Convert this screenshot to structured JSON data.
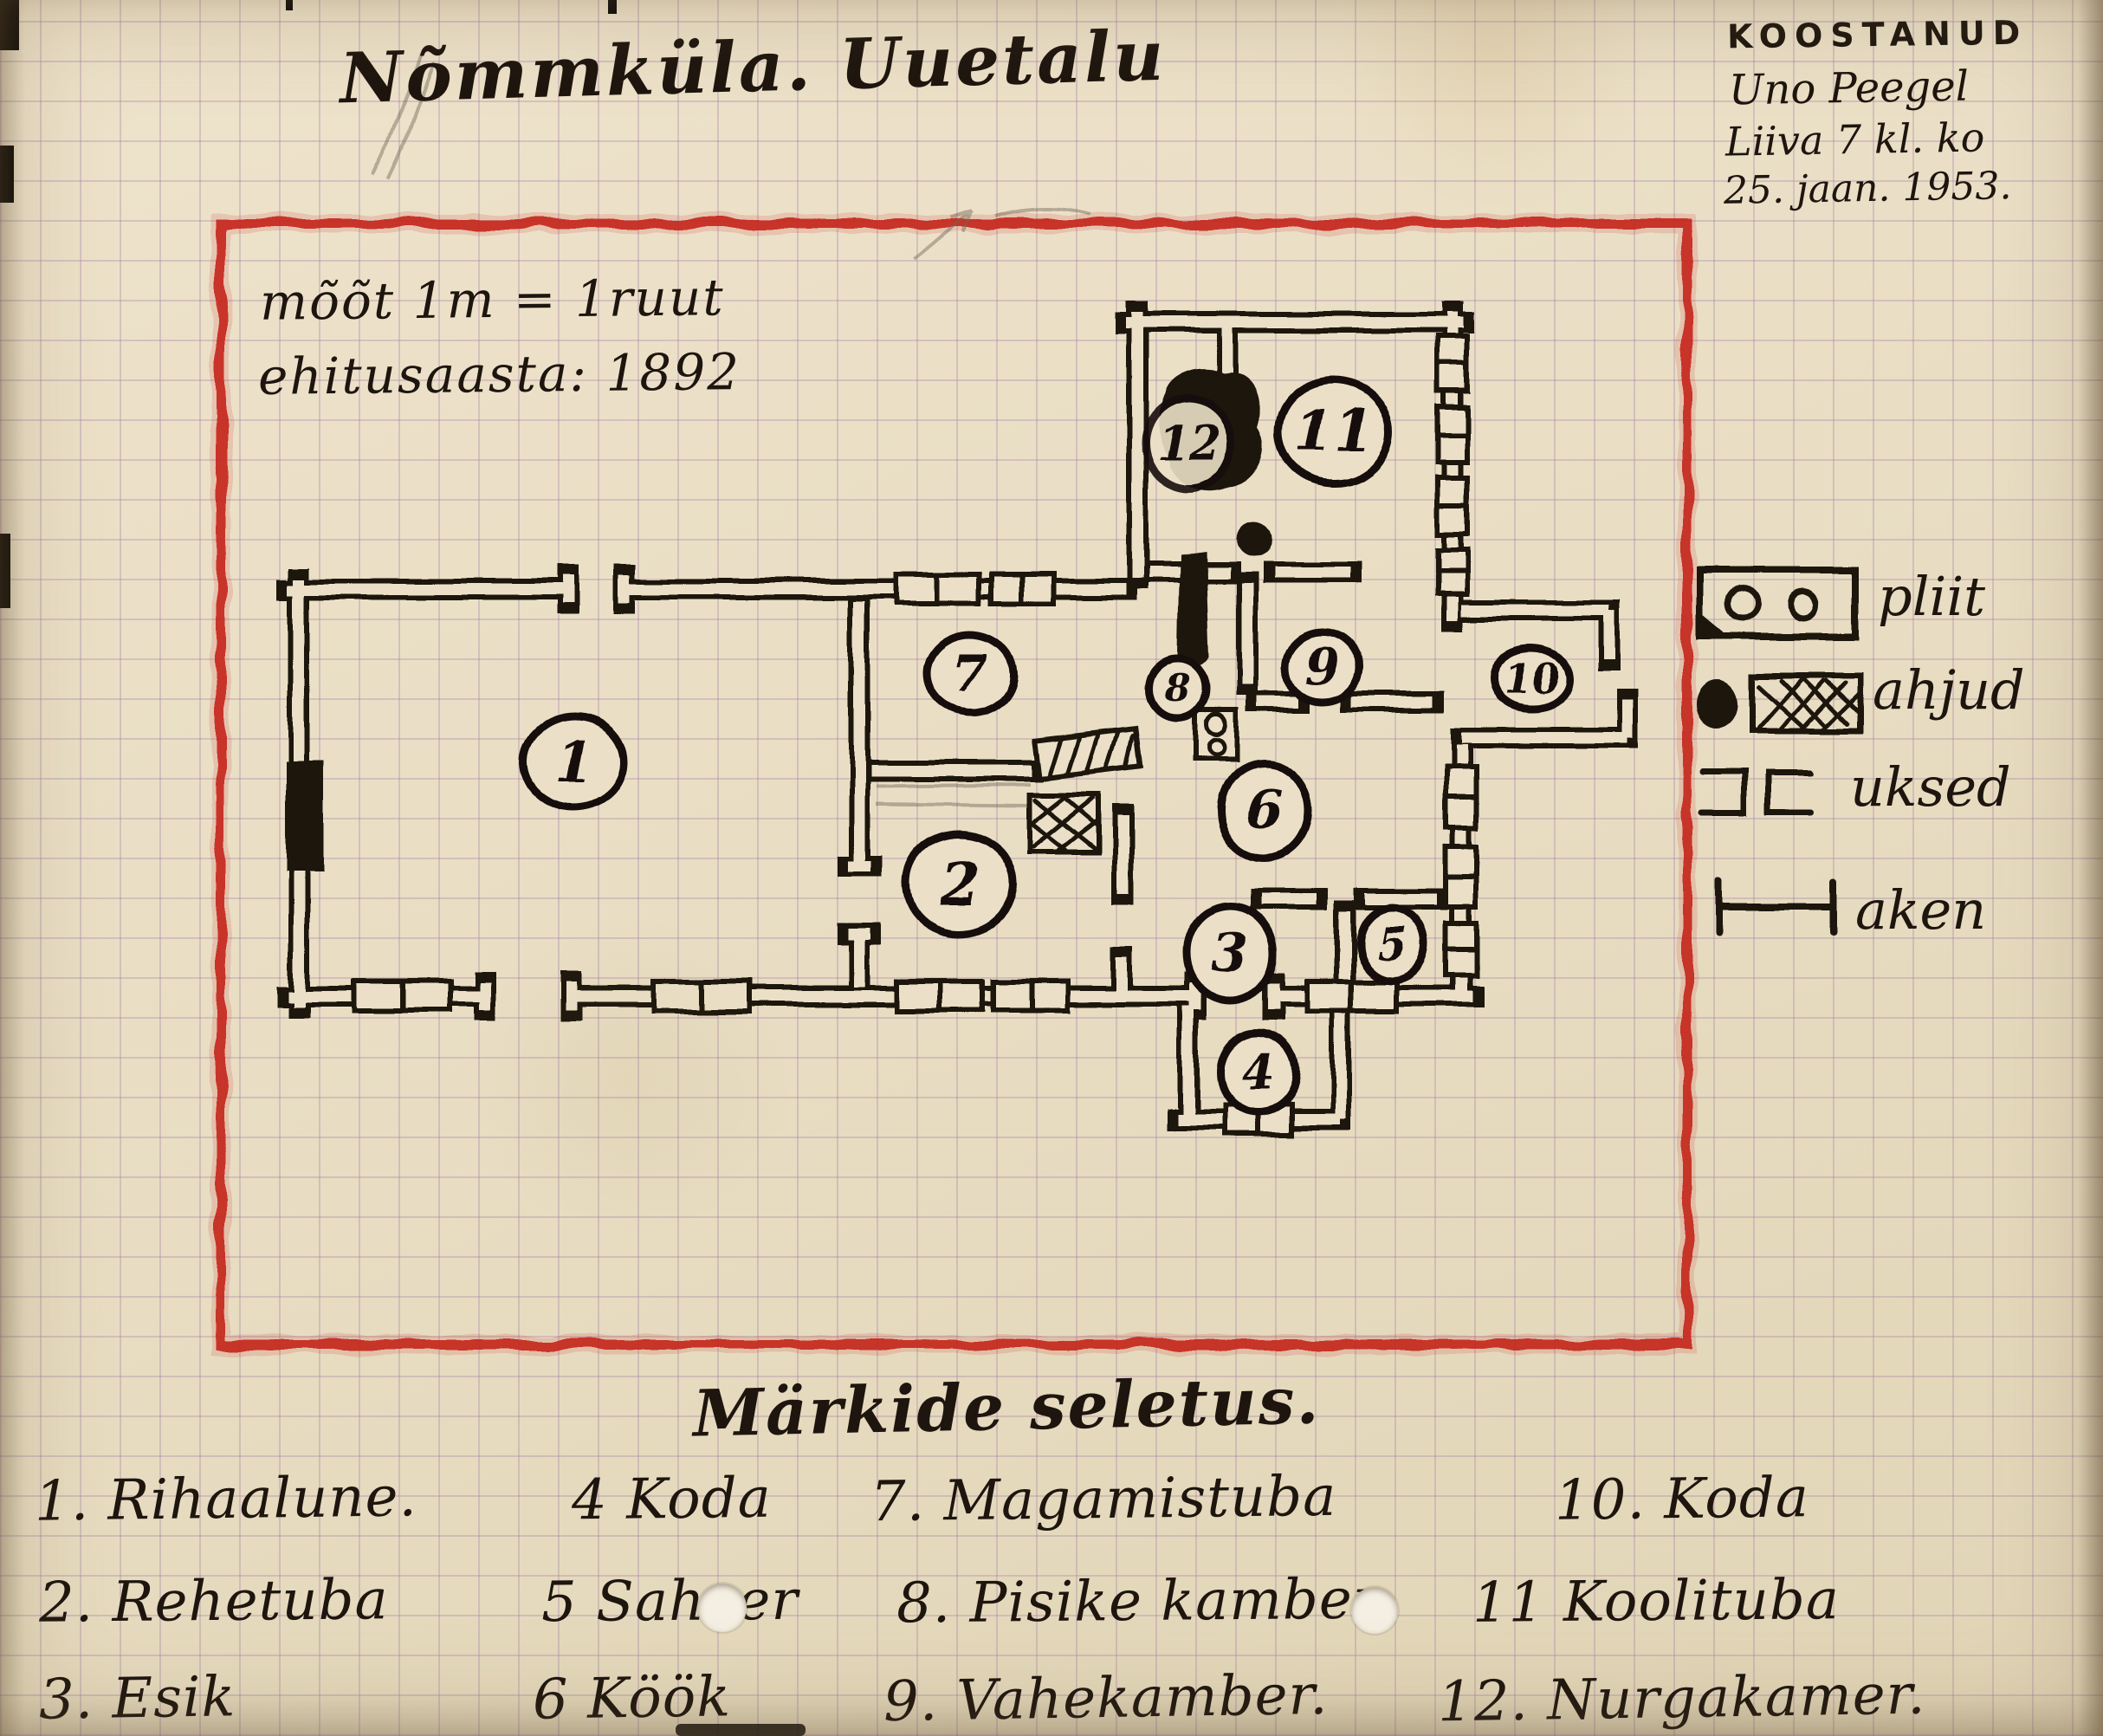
{
  "document": {
    "title": "Nõmmküla. Uuetalu",
    "author_block": {
      "heading": "KOOSTANUD",
      "name": "Uno Peegel",
      "school": "Liiva 7 kl. ko",
      "date": "25. jaan. 1953."
    },
    "scale_note": "mõõt 1m = 1ruut",
    "build_year_note": "ehitusaasta: 1892"
  },
  "plan": {
    "rooms": [
      {
        "number": "1"
      },
      {
        "number": "2"
      },
      {
        "number": "3"
      },
      {
        "number": "4"
      },
      {
        "number": "5"
      },
      {
        "number": "6"
      },
      {
        "number": "7"
      },
      {
        "number": "8"
      },
      {
        "number": "9"
      },
      {
        "number": "10"
      },
      {
        "number": "11"
      },
      {
        "number": "12"
      }
    ]
  },
  "legend": {
    "items": [
      {
        "symbol": "stove-symbol",
        "label": "pliit"
      },
      {
        "symbol": "oven-symbol",
        "label": "ahjud"
      },
      {
        "symbol": "door-symbol",
        "label": "uksed"
      },
      {
        "symbol": "window-symbol",
        "label": "aken"
      }
    ]
  },
  "key": {
    "heading": "Märkide seletus.",
    "rows": [
      [
        "1. Rihaalune.",
        "4 Koda",
        "7. Magamistuba",
        "10. Koda"
      ],
      [
        "2. Rehetuba",
        "5 Sahver",
        "8. Pisike kamber",
        "11 Koolituba"
      ],
      [
        "3. Esik",
        "6 Köök",
        "9. Vahekamber.",
        "12. Nurgakamer."
      ]
    ]
  },
  "colors": {
    "ink": "#1c140d",
    "crayon_red": "#c5281d",
    "paper": "#ebe0c7"
  }
}
